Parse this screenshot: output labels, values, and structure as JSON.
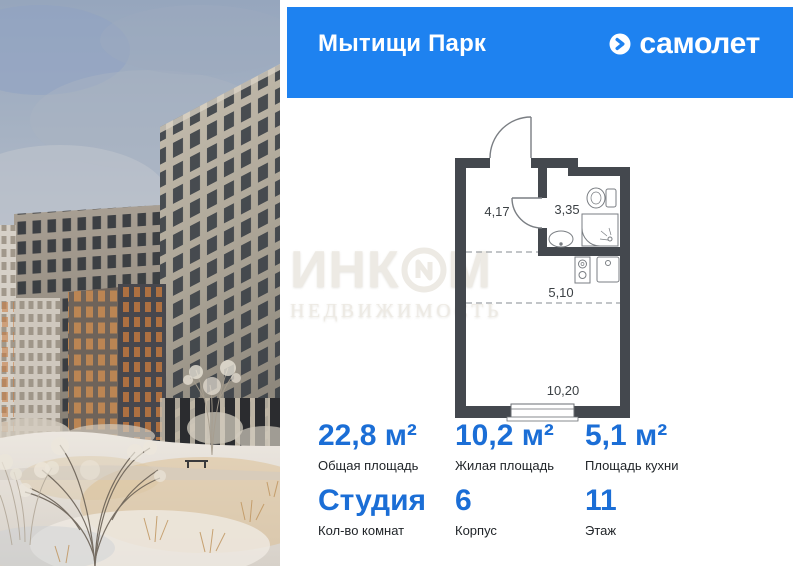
{
  "header": {
    "project_name": "Мытищи Парк",
    "brand_name": "самолет",
    "bg_color": "#1E82F0"
  },
  "floor_plan": {
    "rooms": [
      {
        "name": "hallway",
        "area_label": "4,17"
      },
      {
        "name": "bathroom",
        "area_label": "3,35"
      },
      {
        "name": "kitchen-zone",
        "area_label": "5,10"
      },
      {
        "name": "living-room",
        "area_label": "10,20"
      }
    ],
    "wall_color": "#44484E"
  },
  "stats": {
    "row1": [
      {
        "value": "22,8 м²",
        "label": "Общая площадь"
      },
      {
        "value": "10,2 м²",
        "label": "Жилая площадь"
      },
      {
        "value": "5,1 м²",
        "label": "Площадь кухни"
      }
    ],
    "row2": [
      {
        "value": "Студия",
        "label": "Кол-во комнат"
      },
      {
        "value": "6",
        "label": "Корпус"
      },
      {
        "value": "11",
        "label": "Этаж"
      }
    ],
    "accent_color": "#1B6ED6",
    "label_color": "#212529"
  },
  "watermark": {
    "line1_prefix": "ИНК",
    "line1_suffix": "М",
    "line2": "НЕДВИЖИМОСТЬ"
  }
}
